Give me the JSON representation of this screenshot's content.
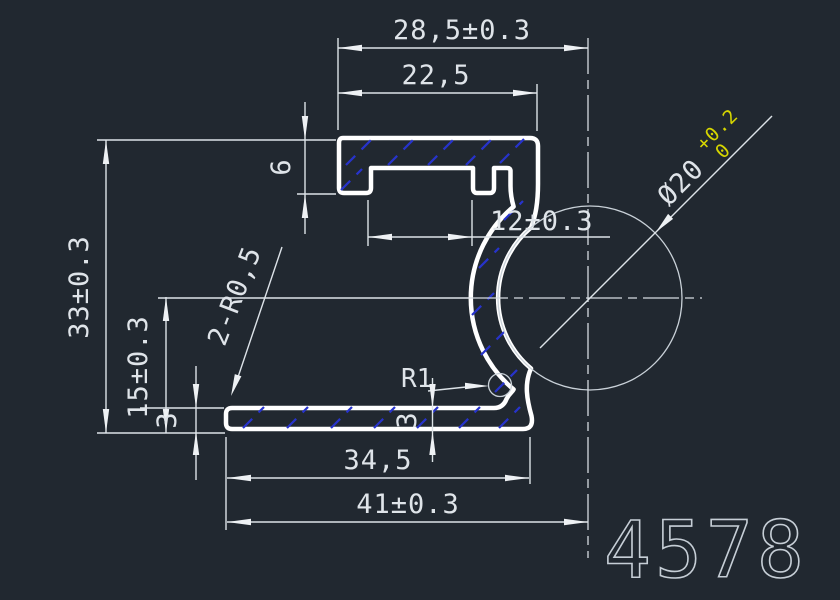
{
  "drawing": {
    "part_number": "4578",
    "colors": {
      "background": "#212830",
      "profile_line": "#ffffff",
      "dimension_line": "#dde3e8",
      "hatch": "#2733cb",
      "tolerance_text": "#d6d600",
      "part_number_text": "#c6ced6"
    },
    "dimensions": {
      "top_overall": "28,5±0.3",
      "top_inner": "22,5",
      "left_overall": "33±0.3",
      "groove_center_height": "15±0.3",
      "foot_depth": "6",
      "slot_opening": "12±0.3",
      "corner_radius_note": "2-R0,5",
      "fillet_radius": "R1",
      "flange_thickness_left": "3",
      "flange_thickness_right": "3",
      "bottom_inner": "34,5",
      "bottom_overall": "41±0.3",
      "groove_diameter": "Ø20",
      "groove_tolerance_upper": "+0.2",
      "groove_tolerance_lower": "0"
    }
  }
}
